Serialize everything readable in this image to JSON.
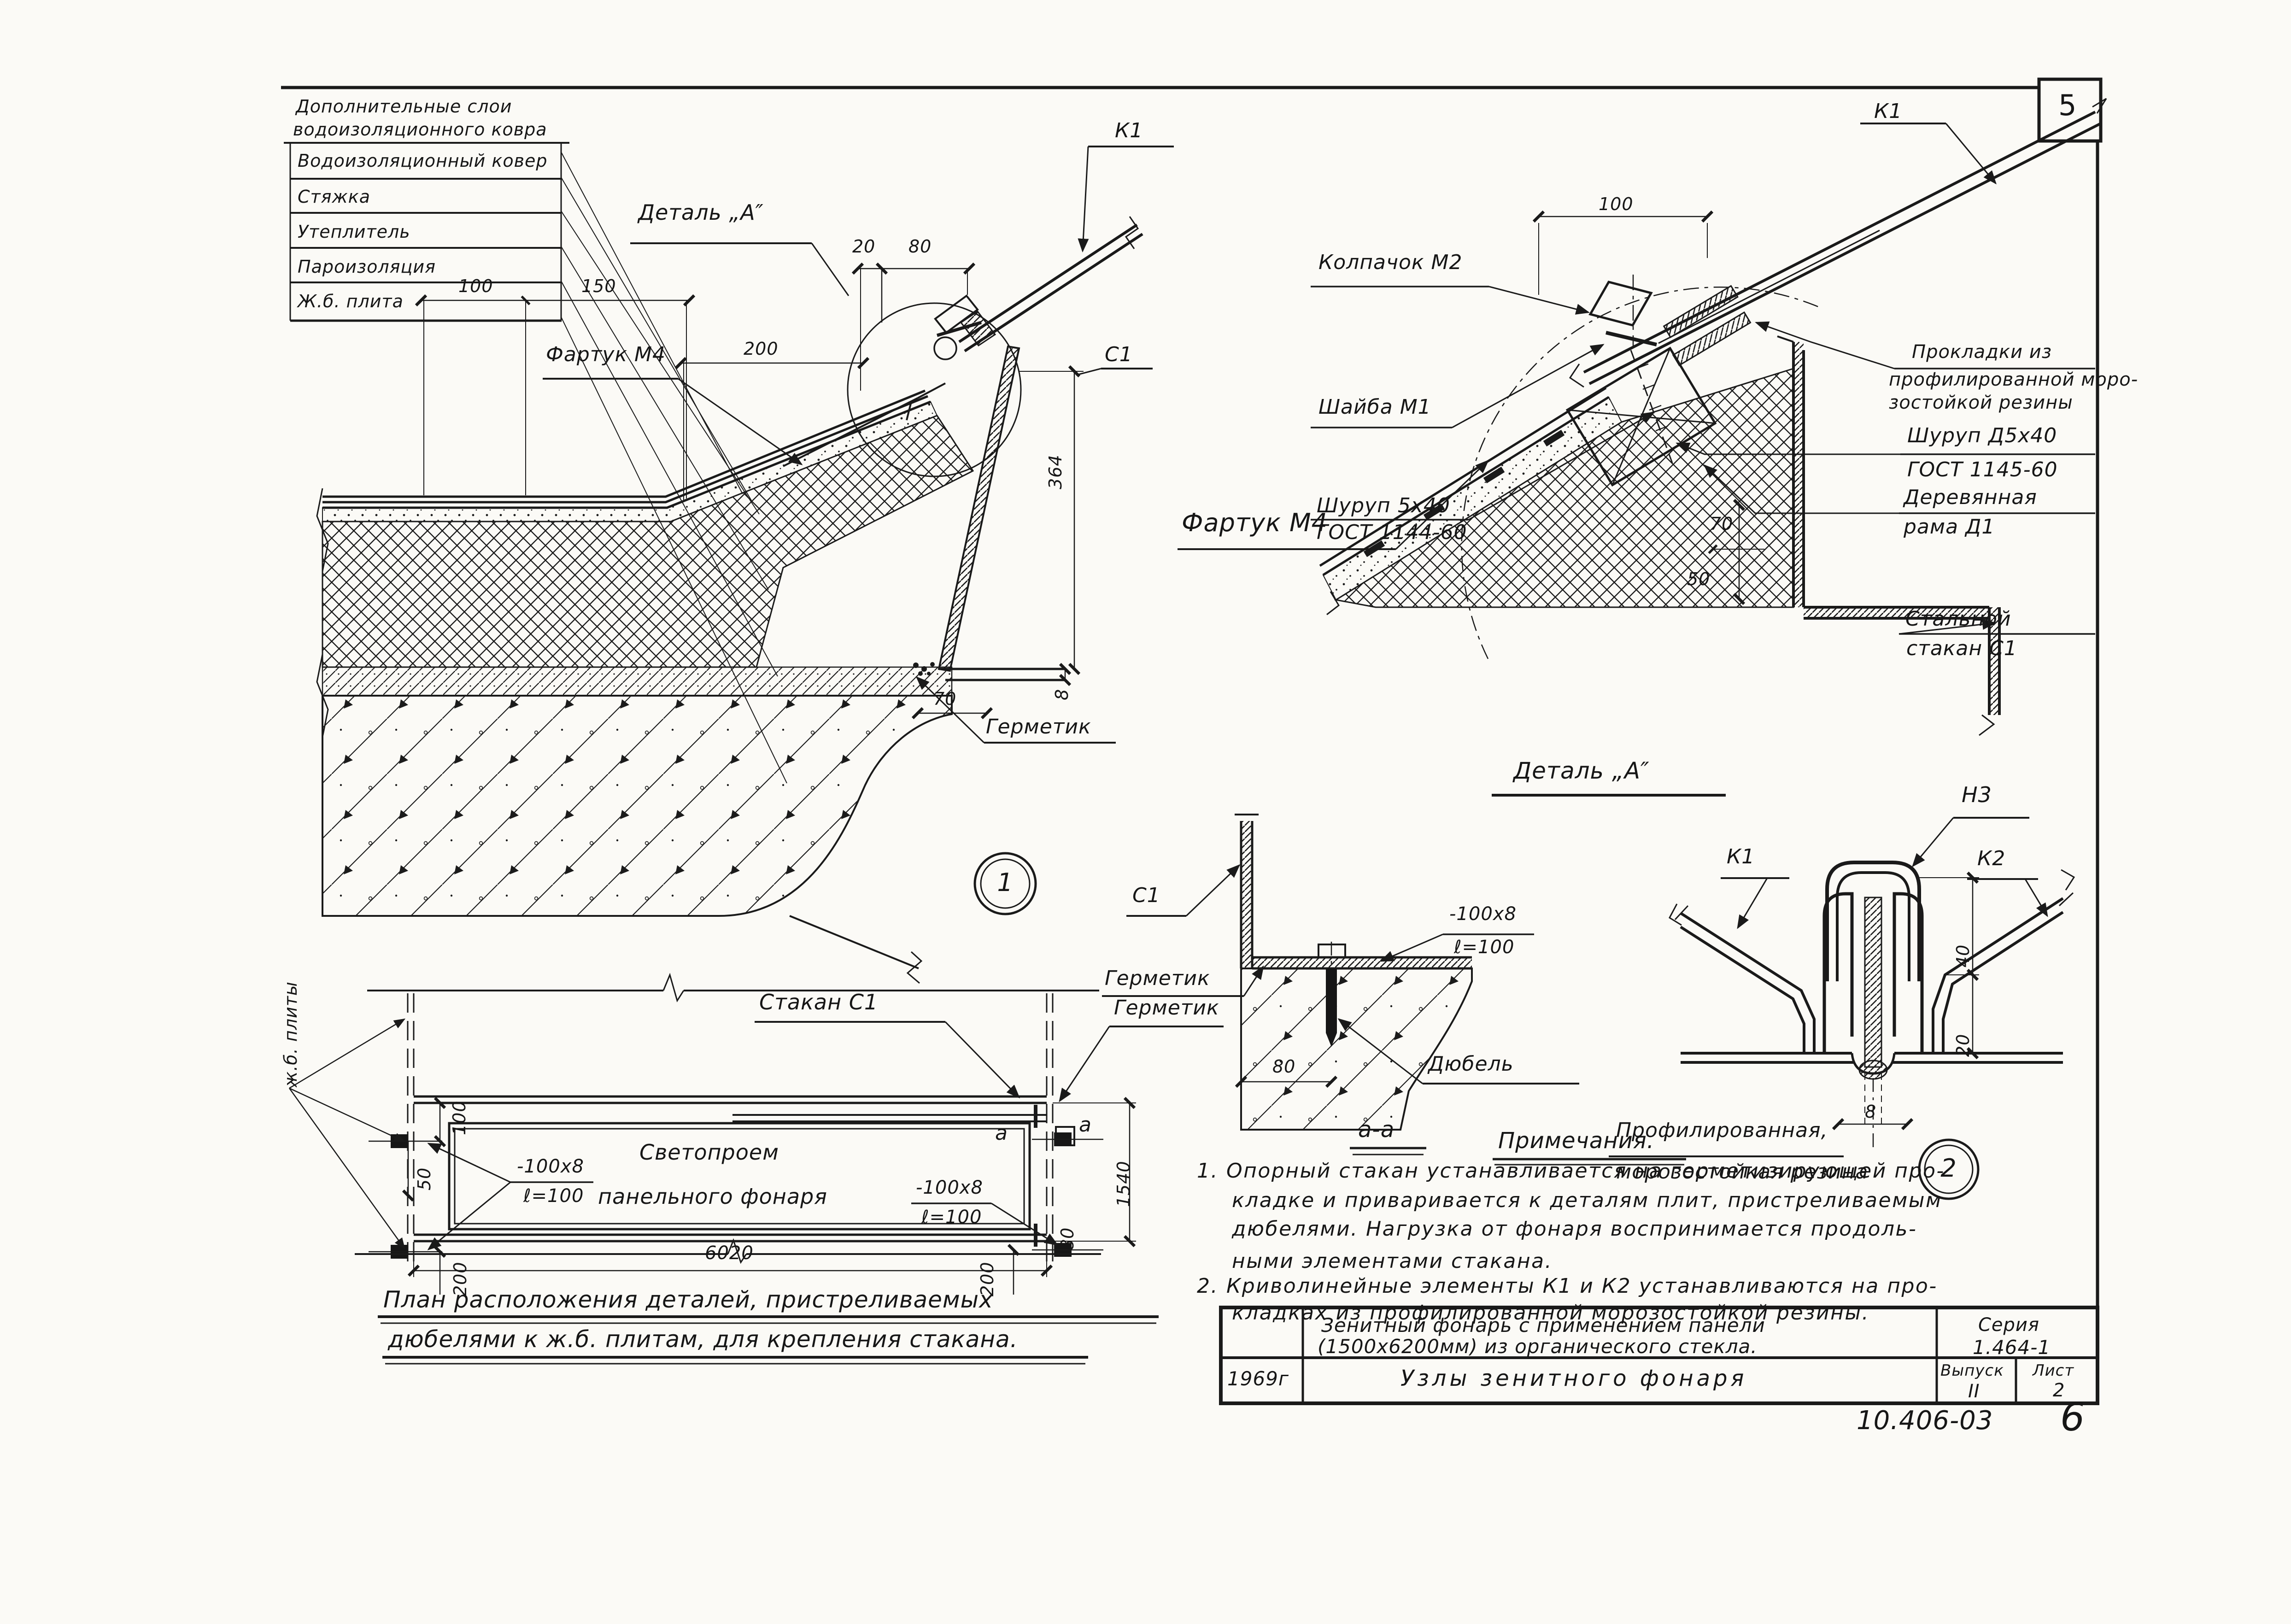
{
  "colors": {
    "ink": "#1a1a1a",
    "paper": "#fbfaf6"
  },
  "page": {
    "frame_badge": "5",
    "footer_code": "10.406-03",
    "footer_page": "6"
  },
  "legend": {
    "header1": "Дополнительные слои",
    "header2": "водоизоляционного ковра",
    "rows": [
      "Водоизоляционный ковер",
      "Стяжка",
      "Утеплитель",
      "Пароизоляция",
      "Ж.б. плита"
    ]
  },
  "node1": {
    "callout": "Деталь „А″",
    "apron": "Фартук М4",
    "k1": "К1",
    "c1": "С1",
    "sealant": "Герметик",
    "badge": "1",
    "dims": {
      "d20": "20",
      "d80": "80",
      "d100": "100",
      "d150": "150",
      "d200": "200",
      "d364": "364",
      "d8": "8",
      "d70": "70"
    }
  },
  "detail_a": {
    "title": "Деталь „А″",
    "k1": "К1",
    "apron": "Фартук М4",
    "cap": "Колпачок М2",
    "washer": "Шайба М1",
    "screw1": "Шуруп 5х40",
    "screw1_gost": "ГОСТ 1144-60",
    "gasket1": "Прокладки из",
    "gasket2": "профилированной моро-",
    "gasket3": "зостойкой резины",
    "screw2": "Шуруп Д5х40",
    "screw2_gost": "ГОСТ 1145-60",
    "frame1": "Деревянная",
    "frame2": "рама Д1",
    "cup1": "Стальной",
    "cup2": "стакан С1",
    "dims": {
      "d100": "100",
      "d70": "70",
      "d50": "50"
    }
  },
  "plan": {
    "cup": "Стакан С1",
    "sealant": "Герметик",
    "opening1": "Светопроем",
    "opening2": "панельного фонаря",
    "plates": "ж.б. плиты",
    "strip_num": "-100х8",
    "strip_len": "ℓ=100",
    "sec": "а",
    "caption1": "План расположения деталей, пристреливаемых",
    "caption2": "дюбелями к ж.б. плитам, для крепления стакана.",
    "dims": {
      "d100": "100",
      "d50": "50",
      "d200": "200",
      "d80": "80",
      "d1540": "1540",
      "d6020": "6020"
    }
  },
  "section_aa": {
    "c1": "С1",
    "sealant": "Герметик",
    "strip_num": "-100х8",
    "strip_len": "ℓ=100",
    "dowel": "Дюбель",
    "d80": "80",
    "title": "а-а"
  },
  "detail2": {
    "n3": "Н3",
    "k1": "К1",
    "k2": "К2",
    "caption1": "Профилированная,",
    "caption2": "морозостойкая резина",
    "badge": "2",
    "dims": {
      "d40": "40",
      "d20": "20",
      "d8": "8"
    }
  },
  "notes": {
    "title": "Примечания.",
    "n1": "1.",
    "n2": "2.",
    "lines1": [
      "Опорный стакан устанавливается на герметизирующей про-",
      "кладке и приваривается к деталям плит, пристреливаемым",
      "дюбелями. Нагрузка от фонаря воспринимается продоль-",
      "ными элементами стакана."
    ],
    "lines2": [
      "Криволинейные элементы К1 и К2 устанавливаются на про-",
      "кладках из профилированной морозостойкой резины."
    ]
  },
  "title_block": {
    "subject1": "Зенитный фонарь с применением панели",
    "subject2": "(1500х6200мм) из органического стекла.",
    "series_label": "Серия",
    "series_value": "1.464-1",
    "year": "1969г",
    "sheet_title": "Узлы зенитного фонаря",
    "issue_label": "Выпуск",
    "issue_value": "II",
    "sheet_label": "Лист",
    "sheet_value": "2"
  }
}
